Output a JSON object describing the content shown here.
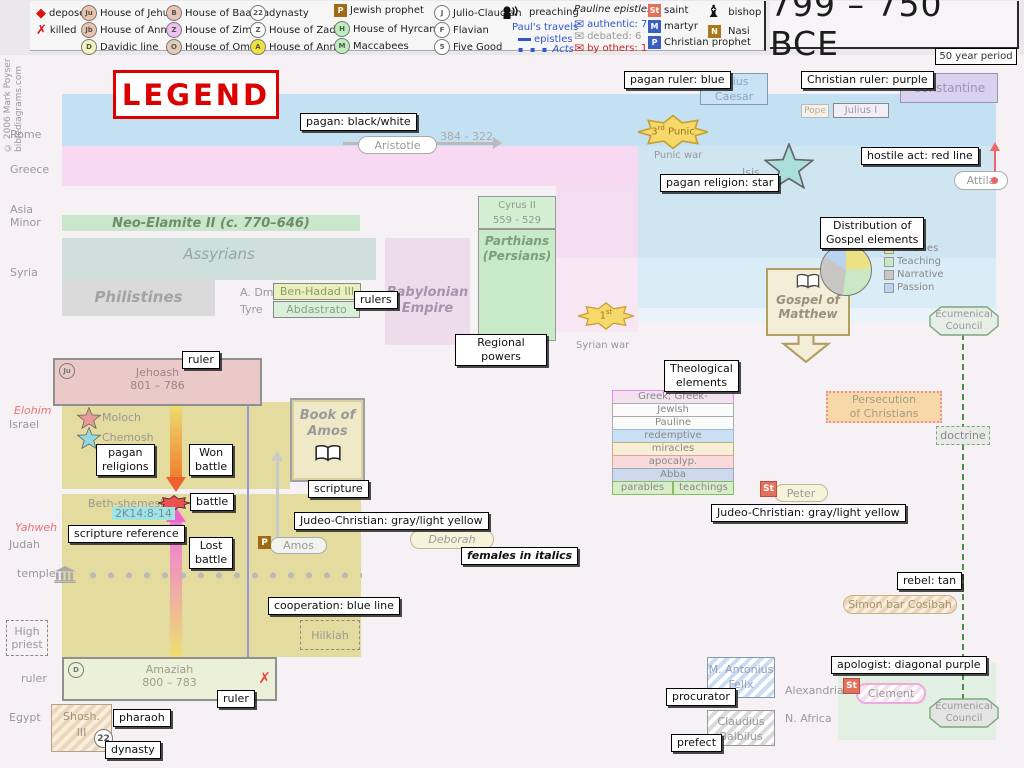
{
  "meta": {
    "copyright1": "© 2006 Mark Poyser",
    "copyright2": "biblediagrams.com"
  },
  "header": {
    "title": "799 – 750 BCE",
    "period": "50 year period"
  },
  "legend_title": "LEGEND",
  "toolbar": {
    "deposed": "deposed",
    "killed": "killed",
    "jehu": "House of Jehu",
    "annas_jb": "House of Annas",
    "davidic": "Davidic line",
    "baasha": "House of Baasha",
    "zimri": "House of Zimri",
    "omri": "House of Omri",
    "dynasty": "dynasty",
    "zadok": "House of Zadok",
    "annas_a": "House of Annas",
    "jewish_prophet": "Jewish prophet",
    "hyrcanus": "House of Hyrcanus",
    "maccabees": "Maccabees",
    "julio": "Julio-Claudian",
    "flavian": "Flavian",
    "five_good": "Five Good",
    "preaching": "preaching",
    "pauls": "Paul's travels",
    "epistles": "epistles",
    "acts": "Acts",
    "pauline": "Pauline epistles",
    "authentic": "authentic: 7",
    "debated": "debated: 6",
    "by_others": "by others: 1",
    "saint": "saint",
    "martyr": "martyr",
    "christian_prophet": "Christian prophet",
    "bishop": "bishop",
    "nasi": "Nasi",
    "b": {
      "ju": "Ju",
      "jb": "Jb",
      "d": "D",
      "ba": "B",
      "z": "Z",
      "o": "O",
      "c22": "22",
      "z2": "Z",
      "a": "A",
      "p": "P",
      "h": "H",
      "m": "M",
      "j": "J",
      "f": "F",
      "five": "5",
      "st": "St",
      "mm": "M",
      "pp": "P",
      "n": "N"
    },
    "icons": {
      "deposed": "◆",
      "killed": "✗",
      "envelope": "✉",
      "bishop": "♝"
    }
  },
  "margin": {
    "rome": "Rome",
    "greece": "Greece",
    "asia": "Asia\nMinor",
    "syria": "Syria",
    "elohim": "Elohim",
    "israel": "Israel",
    "yahweh": "Yahweh",
    "judah": "Judah",
    "temple": "temple",
    "high_priest": "High\npriest",
    "ruler": "ruler",
    "egypt": "Egypt"
  },
  "callouts": {
    "pagan_bw": "pagan: black/white",
    "pagan_ruler": "pagan ruler: blue",
    "christian_ruler": "Christian ruler: purple",
    "pagan_religion": "pagan religion: star",
    "hostile": "hostile act: red line",
    "distribution": "Distribution of\nGospel elements",
    "theological": "Theological\nelements",
    "regional": "Regional\npowers",
    "rulers": "rulers",
    "ruler": "ruler",
    "pagan_religions": "pagan\nreligions",
    "won_battle": "Won\nbattle",
    "lost_battle": "Lost\nbattle",
    "battle": "battle",
    "scripture": "scripture",
    "scripture_reference": "scripture reference",
    "judeo": "Judeo-Christian: gray/light yellow",
    "females": "females in italics",
    "cooperation": "cooperation: blue line",
    "rebel": "rebel: tan",
    "apologist": "apologist: diagonal purple",
    "procurator": "procurator",
    "prefect": "prefect",
    "pharaoh": "pharaoh",
    "dynasty": "dynasty"
  },
  "rome": {
    "aristotle": "Aristotle",
    "aristotle_years": "384 - 322",
    "julius_caesar": "Julius\nCaesar",
    "constantine": "Constantine",
    "pope": "Pope",
    "julius_i": "Julius I",
    "punic_num": "3",
    "punic_sup": "rd",
    "punic_rest": "Punic",
    "punic_war": "Punic war",
    "isis": "Isis",
    "attila": "Attila"
  },
  "east": {
    "neo_elamite": "Neo-Elamite II (c. 770–646)",
    "assyrians": "Assyrians",
    "philistines": "Philistines",
    "a_dm": "A. Dm.",
    "ben_hadad": "Ben-Hadad III",
    "tyre": "Tyre",
    "abdastrato": "Abdastrato",
    "babylonian": "Babylonian\nEmpire",
    "cyrus": "Cyrus II\n559 - 529",
    "parthians": "Parthians\n(Persians)",
    "syrian_num": "1",
    "syrian_sup": "st",
    "syrian_war": "Syrian war"
  },
  "gospel": {
    "matthew": "Gospel of\nMatthew",
    "council": "Ecumenical\nCouncil",
    "doctrine": "doctrine",
    "persecution": "Persecution\nof Christians",
    "peter_st": "St",
    "peter": "Peter",
    "simon": "Simon bar Cosibah",
    "clement_st": "St",
    "clement": "Clement",
    "alexandria": "Alexandria",
    "n_africa": "N. Africa",
    "felix": "M. Antonius\nFelix",
    "claudius": "Claudius\nBalbilus"
  },
  "theo": {
    "rows": [
      "Greek; Greek-compatible",
      "Jewish",
      "Pauline",
      "redemptive",
      "miracles",
      "apocalyp.",
      "Abba"
    ],
    "parables": "parables",
    "teachings": "teachings"
  },
  "israel": {
    "jehoash": "Jehoash",
    "jehoash_years": "801 – 786",
    "ju": "Ju",
    "moloch": "Moloch",
    "chemosh": "Chemosh",
    "book_amos": "Book of\nAmos",
    "beth_shemesh": "Beth-shemesh",
    "ref": "2K14:8-14",
    "amos_p": "P",
    "amos": "Amos",
    "deborah": "Deborah",
    "hilkiah": "Hilkiah",
    "amaziah": "Amaziah",
    "amaziah_years": "800 – 783",
    "d": "D",
    "killed_x": "✗",
    "shosh": "Shosh.\nIII",
    "dyn22": "22"
  },
  "chart_data": {
    "type": "pie",
    "title": "Distribution of Gospel elements",
    "labels": [
      "Miracles",
      "Teaching",
      "Narrative",
      "Passion"
    ],
    "values": [
      24,
      28,
      32,
      16
    ],
    "colors": [
      "#ece185",
      "#c9e9c4",
      "#c9c6c6",
      "#b9d4ef"
    ],
    "legend_position": "right"
  }
}
